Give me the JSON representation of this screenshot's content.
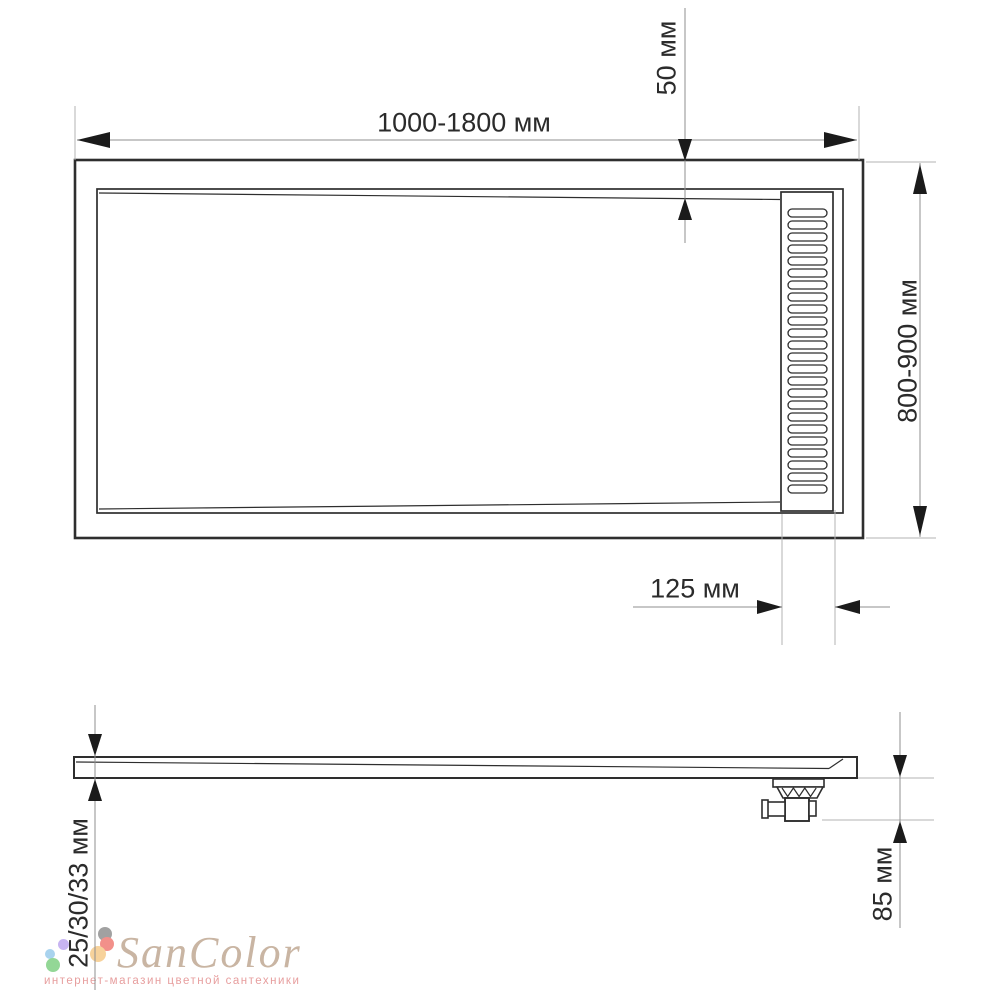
{
  "drawing": {
    "description_colors": {
      "outline": "#2e2e2e",
      "dimension_line": "#8f8f8f",
      "extension_line": "#b3b3b3",
      "arrow": "#1b1b1b",
      "label_text": "#2b2b2b",
      "background": "#ffffff"
    }
  },
  "top_view": {
    "dim_width": {
      "label": "1000-1800 мм"
    },
    "dim_drain_top_offset": {
      "label": "50 мм"
    },
    "dim_depth": {
      "label": "800-900 мм"
    },
    "dim_drain_side_offset": {
      "label": "125 мм"
    },
    "grille": {
      "slot_count": 24
    }
  },
  "side_view": {
    "dim_thickness": {
      "label": "25/30/33 мм"
    },
    "dim_trap_height": {
      "label": "85 мм"
    }
  },
  "watermark": {
    "brand": "SanColor",
    "tagline": "интернет-магазин цветной сантехники",
    "brand_color": "#c9b5a3",
    "tagline_color": "#e79e9e",
    "dot_colors": [
      "#a1a1a1",
      "#f2908a",
      "#c7b4f2",
      "#a9d3ee",
      "#f7d29b",
      "#93d796"
    ]
  }
}
